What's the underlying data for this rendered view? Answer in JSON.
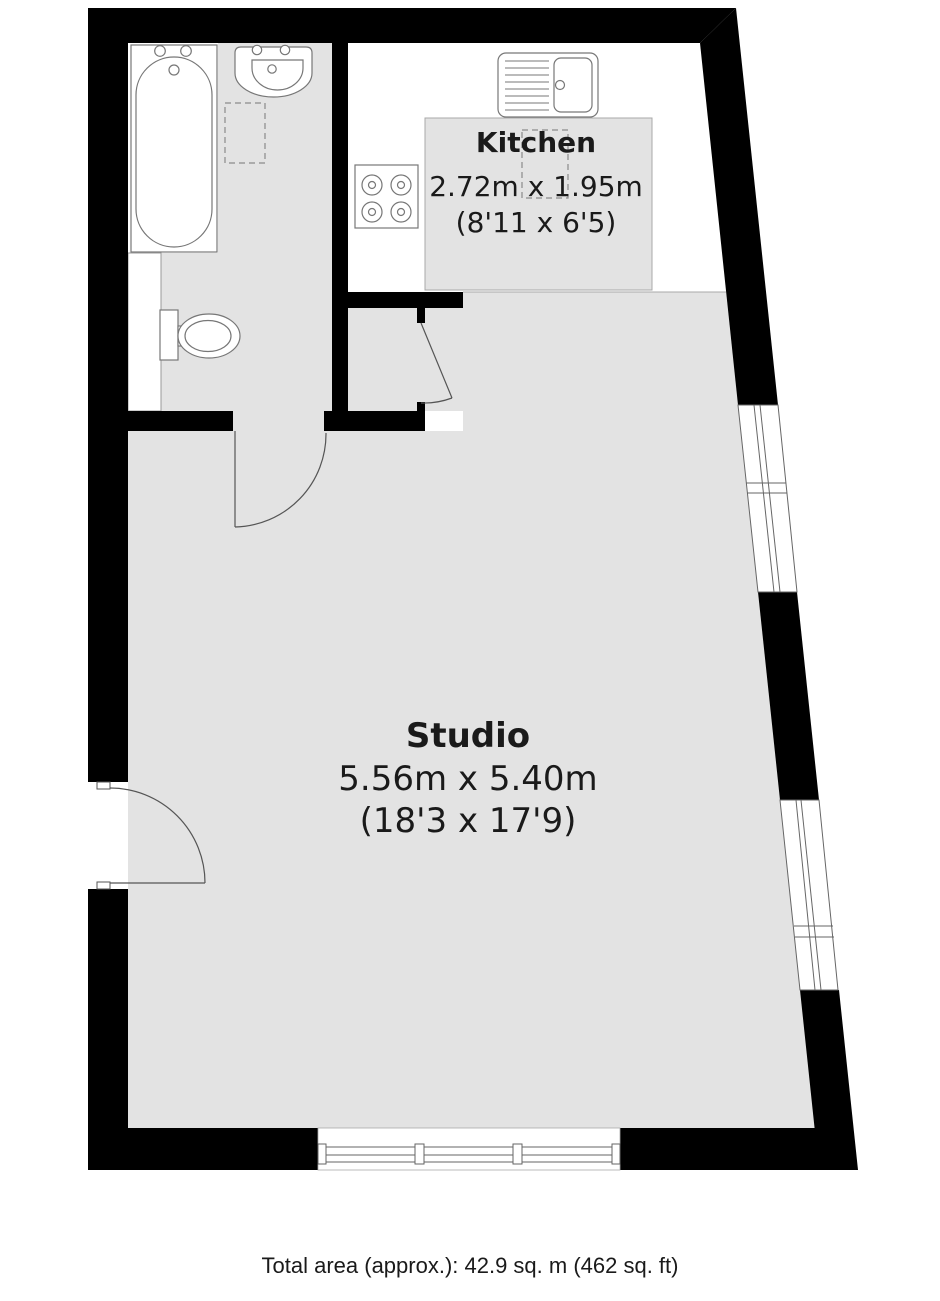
{
  "floorplan": {
    "colors": {
      "wall": "#000000",
      "floor": "#e3e3e3",
      "fixture_stroke": "#777777",
      "text": "#1a1a1a",
      "background": "#ffffff"
    },
    "rooms": [
      {
        "name": "Kitchen",
        "dims_metric": "2.72m x 1.95m",
        "dims_imperial": "(8'11 x 6'5)"
      },
      {
        "name": "Studio",
        "dims_metric": "5.56m x 5.40m",
        "dims_imperial": "(18'3 x 17'9)"
      }
    ],
    "fixtures": [
      "bathtub",
      "washbasin",
      "toilet",
      "kitchen-sink",
      "hob",
      "storage-dashed-box",
      "appliance-dashed-box"
    ],
    "openings": [
      "entrance-door",
      "bathroom-door",
      "kitchen-door",
      "window-right-upper",
      "window-right-lower",
      "window-bottom"
    ],
    "footer": {
      "total_area": "Total area (approx.): 42.9 sq. m (462 sq. ft)"
    }
  }
}
